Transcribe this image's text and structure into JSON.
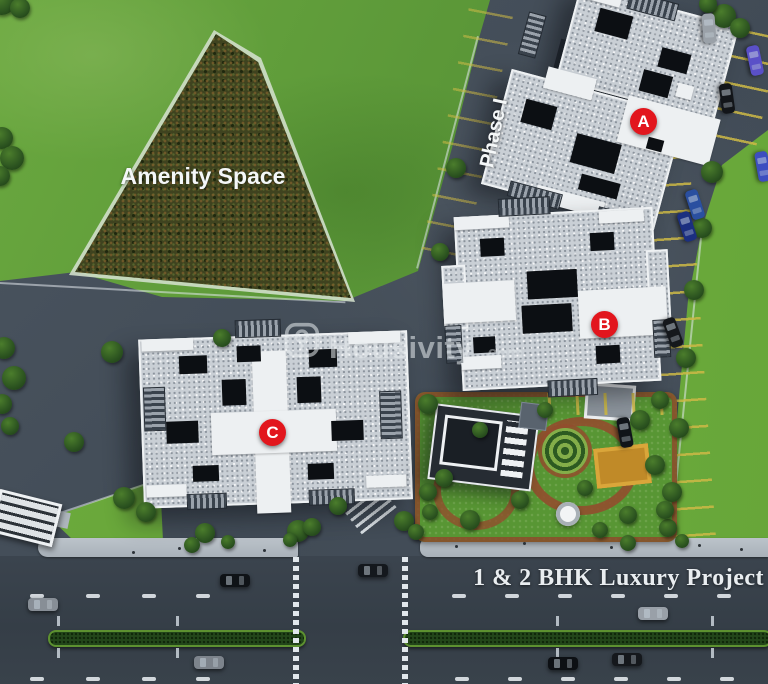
{
  "labels": {
    "amenity_space": "Amenity Space",
    "phase": "Phase I",
    "tagline": "1 & 2 BHK Luxury Project"
  },
  "watermark": {
    "brand": "Housivity",
    "suffix": ".com"
  },
  "buildings": [
    {
      "label": "A"
    },
    {
      "label": "B"
    },
    {
      "label": "C"
    }
  ],
  "colors": {
    "badge_red": "#e2161d",
    "label_white": "#f4f7f8",
    "grass": "#64a23c",
    "grass_bright": "#74b23e",
    "pavement": "#46505b",
    "road": "#39424b",
    "sidewalk": "#b2bac2",
    "amenity_fill": "#3f431f",
    "parking_line_yellow": "#cdb946",
    "hedge_green": "#5d9130",
    "terracotta_path": "#8d4b2c",
    "court_yellow": "#c08a28"
  }
}
